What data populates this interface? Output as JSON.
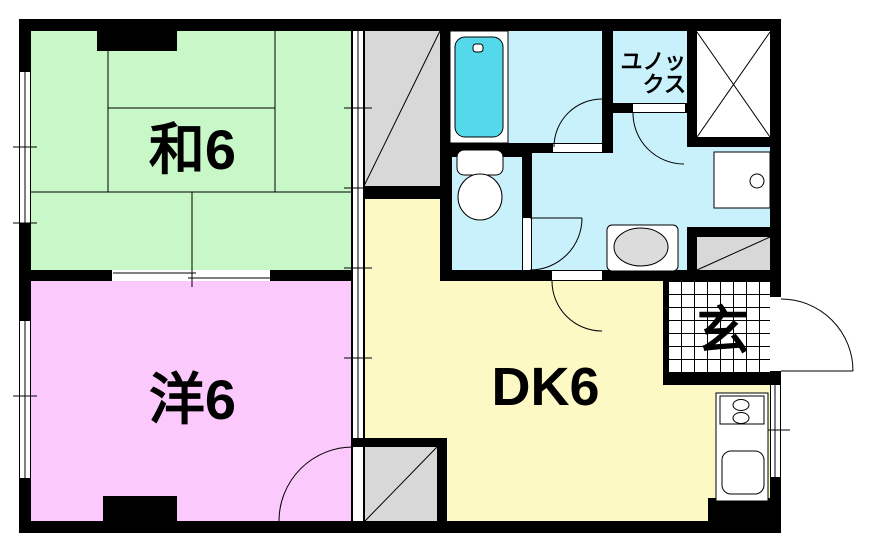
{
  "labels": {
    "washitsu": "和6",
    "western": "洋6",
    "dk": "DK6",
    "genkan": "玄",
    "unit_bath": "ユノックス"
  },
  "colors": {
    "washitsu": "#c8f8c8",
    "western": "#fbc9fb",
    "dk": "#fcf9c4",
    "sanitary": "#c9f1fb",
    "bathtub": "#54d9ea",
    "storage": "#d8d8d8",
    "appliance_gray": "#dcdcdc",
    "floor_white": "#ffffff",
    "wall": "#000000"
  }
}
